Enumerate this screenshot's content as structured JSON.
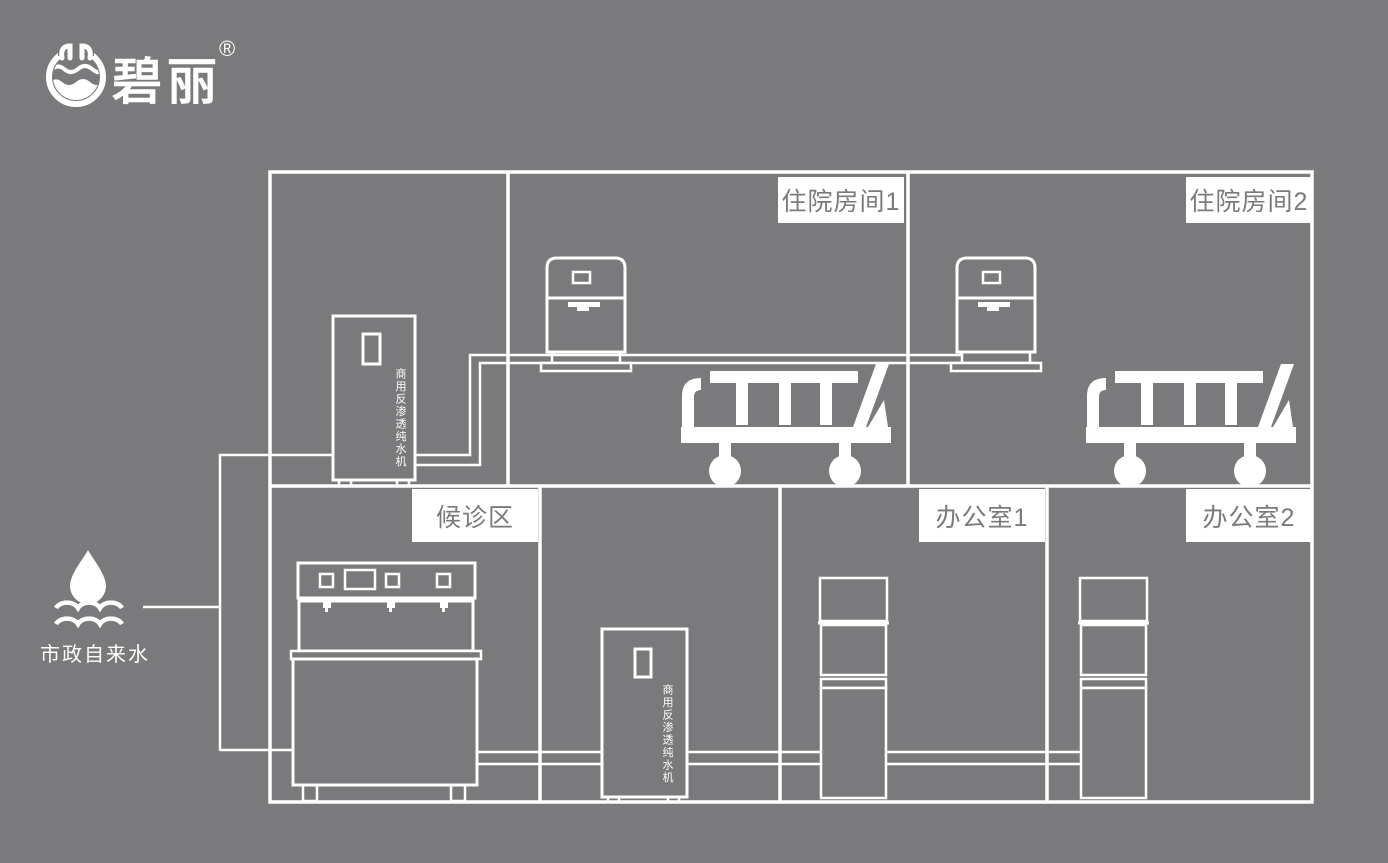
{
  "colors": {
    "background": "#7a7a7c",
    "line": "#ffffff",
    "label_bg": "#ffffff",
    "label_text": "#7a7a7c"
  },
  "logo": {
    "brand": "碧丽",
    "registered": "®"
  },
  "water_source": {
    "label": "市政自来水"
  },
  "rooms": {
    "inpatient1": {
      "label": "住院房间1"
    },
    "inpatient2": {
      "label": "住院房间2"
    },
    "waiting": {
      "label": "候诊区"
    },
    "office1": {
      "label": "办公室1"
    },
    "office2": {
      "label": "办公室2"
    }
  },
  "machines": {
    "ro_machine_upper": {
      "label": "商用反渗透纯水机"
    },
    "ro_machine_lower": {
      "label": "商用反渗透纯水机"
    }
  }
}
